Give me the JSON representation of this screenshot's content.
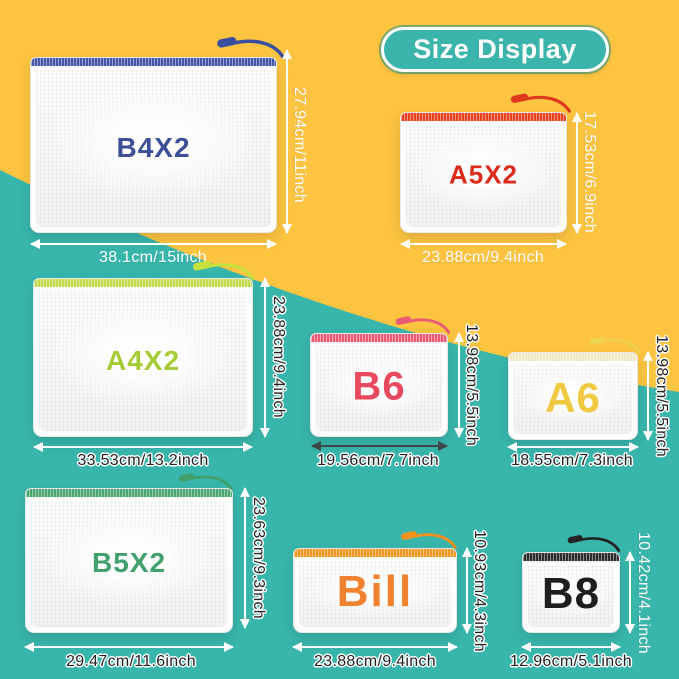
{
  "background": {
    "yellow": "#FCC440",
    "teal": "#38B6AC"
  },
  "title": {
    "label": "Size Display",
    "fill": "#3BB5AB",
    "text_color": "#FFFFFF"
  },
  "pouches": [
    {
      "id": "b4x2",
      "label": "B4X2",
      "label_color": "#3D4F96",
      "zipper_color": "#4656A8",
      "pull_color": "#3A4FA0",
      "width_label": "38.1cm/15inch",
      "height_label": "27.94cm/11inch"
    },
    {
      "id": "a5x2",
      "label": "A5X2",
      "label_color": "#DC2B1B",
      "zipper_color": "#E6401F",
      "pull_color": "#E03A1E",
      "width_label": "23.88cm/9.4inch",
      "height_label": "17.53cm/6.9inch"
    },
    {
      "id": "a4x2",
      "label": "A4X2",
      "label_color": "#A5CC35",
      "zipper_color": "#C3DC4E",
      "pull_color": "#C7E13C",
      "width_label": "33.53cm/13.2inch",
      "height_label": "23.88cm/9.4inch"
    },
    {
      "id": "b6",
      "label": "B6",
      "label_color": "#E9495E",
      "zipper_color": "#EA5A72",
      "pull_color": "#E85A74",
      "width_label": "19.56cm/7.7inch",
      "height_label": "13.98cm/5.5inch"
    },
    {
      "id": "a6",
      "label": "A6",
      "label_color": "#EFC93F",
      "zipper_color": "#F0EAC2",
      "pull_color": "#EDD34F",
      "width_label": "18.55cm/7.3inch",
      "height_label": "13.98cm/5.5inch"
    },
    {
      "id": "b5x2",
      "label": "B5X2",
      "label_color": "#41A06C",
      "zipper_color": "#4BA571",
      "pull_color": "#3FA06B",
      "width_label": "29.47cm/11.6inch",
      "height_label": "23.63cm/9.3inch"
    },
    {
      "id": "bill",
      "label": "Bill",
      "label_color": "#F0822F",
      "zipper_color": "#F6941F",
      "pull_color": "#F5921E",
      "width_label": "23.88cm/9.4inch",
      "height_label": "10.93cm/4.3inch"
    },
    {
      "id": "b8",
      "label": "B8",
      "label_color": "#1E1E1E",
      "zipper_color": "#2E2E2E",
      "pull_color": "#232323",
      "width_label": "12.96cm/5.1inch",
      "height_label": "10.42cm/4.1inch"
    }
  ]
}
